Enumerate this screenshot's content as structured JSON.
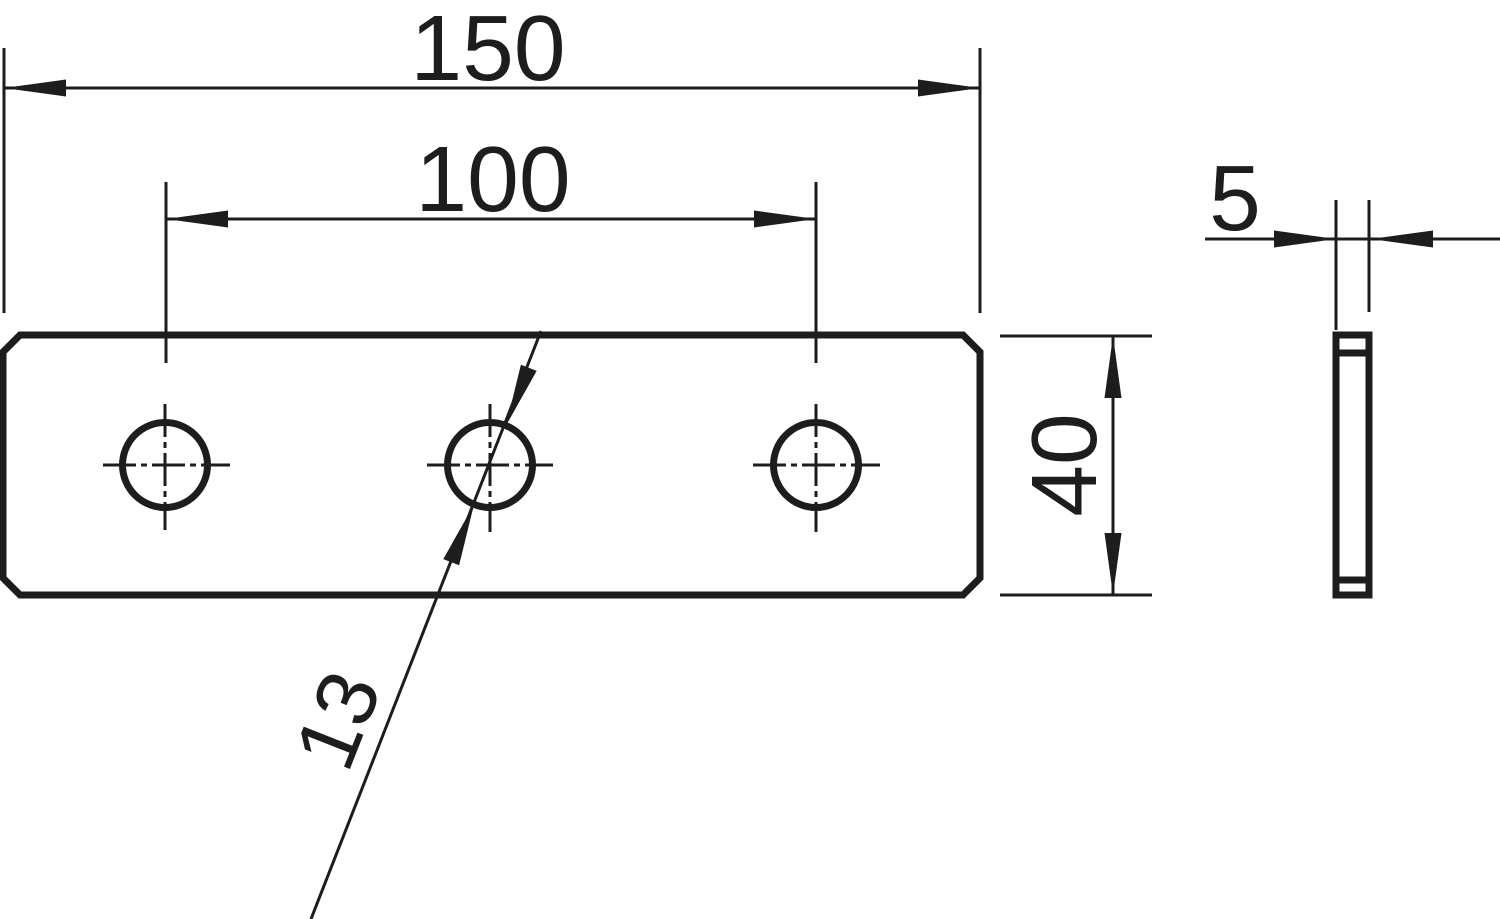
{
  "drawing": {
    "description": "Two-view technical dimension drawing of a flat connector plate with three holes",
    "background_color": "#ffffff",
    "line_color": "#1d1d1b",
    "views": {
      "front_view": {
        "name": "plate front view",
        "hole_count": 3,
        "corner_style": "chamfered"
      },
      "side_view": {
        "name": "plate side view",
        "chamfer_lines": 2
      }
    },
    "dimensions": {
      "overall_length": {
        "label": "150"
      },
      "hole_spacing": {
        "label": "100"
      },
      "plate_height": {
        "label": "40"
      },
      "thickness": {
        "label": "5"
      },
      "hole_diameter": {
        "label": "13"
      }
    }
  }
}
